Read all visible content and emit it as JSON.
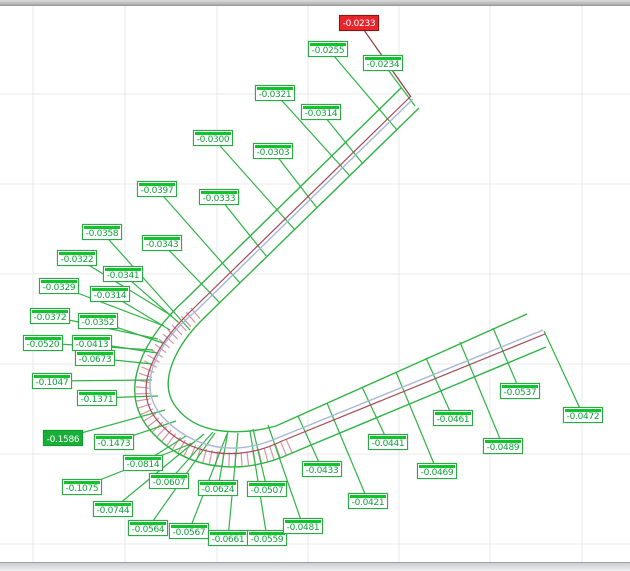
{
  "window": {
    "top_edge_color": "#ababab",
    "scrollbar": {
      "orientation": "horizontal",
      "track_color": "#d9dce0"
    }
  },
  "grid": {
    "color": "#e8e8e8",
    "vlines": [
      33,
      125,
      217,
      308,
      399,
      490,
      582
    ],
    "hlines": [
      94,
      184,
      274,
      364,
      454,
      544
    ]
  },
  "profile": {
    "colors": {
      "tolerance_green": "#2fb345",
      "nominal_blue": "#a8b6d8",
      "measured_red": "#a34a56",
      "whisker_pink": "#d893a1",
      "leader_green": "#2fb345",
      "leader_red": "#8c3a44"
    },
    "paths": {
      "whisker_band": "M 196,313 C 152,349 126,389 155,424 C 190,464 242,468 290,446",
      "outer_green": "M 401,88 L 186,299 C 144,337 116,390 150,430 C 186,472 243,476 292,453 L 546,347",
      "inner_green": "M 419,108 L 205,317 C 178,343 156,381 176,407 C 195,433 235,437 276,426 L 527,314",
      "measured_red": "M 411,96 L 194,308 C 157,343 130,387 157,420 C 188,458 240,462 282,441 L 545,334",
      "nominal_blue": "M 413,99 L 196,311 C 158,342 136,382 160,414 C 192,450 235,457 280,437 L 543,330"
    }
  },
  "measurements": {
    "description": "profile deviation flags",
    "styles": {
      "normal": "green-outline",
      "max": "green-filled",
      "red": "red-filled"
    },
    "labels": [
      {
        "v": "-0.0233",
        "x": 339,
        "y": 15,
        "ax": 411,
        "ay": 97,
        "style": "red"
      },
      {
        "v": "-0.0255",
        "x": 308,
        "y": 41,
        "ax": 397,
        "ay": 130,
        "style": "normal"
      },
      {
        "v": "-0.0234",
        "x": 363,
        "y": 55,
        "ax": 415,
        "ay": 106,
        "style": "normal"
      },
      {
        "v": "-0.0321",
        "x": 255,
        "y": 85,
        "ax": 350,
        "ay": 176,
        "style": "normal"
      },
      {
        "v": "-0.0314",
        "x": 301,
        "y": 104,
        "ax": 363,
        "ay": 164,
        "style": "normal"
      },
      {
        "v": "-0.0300",
        "x": 193,
        "y": 130,
        "ax": 295,
        "ay": 230,
        "style": "normal"
      },
      {
        "v": "-0.0303",
        "x": 253,
        "y": 143,
        "ax": 317,
        "ay": 208,
        "style": "normal"
      },
      {
        "v": "-0.0397",
        "x": 137,
        "y": 181,
        "ax": 240,
        "ay": 283,
        "style": "normal"
      },
      {
        "v": "-0.0333",
        "x": 199,
        "y": 189,
        "ax": 267,
        "ay": 257,
        "style": "normal"
      },
      {
        "v": "-0.0358",
        "x": 82,
        "y": 224,
        "ax": 190,
        "ay": 330,
        "style": "normal"
      },
      {
        "v": "-0.0343",
        "x": 142,
        "y": 235,
        "ax": 220,
        "ay": 303,
        "style": "normal"
      },
      {
        "v": "-0.0322",
        "x": 57,
        "y": 250,
        "ax": 172,
        "ay": 316,
        "style": "normal"
      },
      {
        "v": "-0.0341",
        "x": 103,
        "y": 266,
        "ax": 178,
        "ay": 322,
        "style": "normal"
      },
      {
        "v": "-0.0329",
        "x": 39,
        "y": 278,
        "ax": 164,
        "ay": 326,
        "style": "normal"
      },
      {
        "v": "-0.0314",
        "x": 90,
        "y": 286,
        "ax": 170,
        "ay": 330,
        "style": "normal"
      },
      {
        "v": "-0.0372",
        "x": 30,
        "y": 308,
        "ax": 158,
        "ay": 339,
        "style": "normal"
      },
      {
        "v": "-0.0352",
        "x": 78,
        "y": 313,
        "ax": 163,
        "ay": 343,
        "style": "normal"
      },
      {
        "v": "-0.0520",
        "x": 23,
        "y": 335,
        "ax": 153,
        "ay": 350,
        "style": "normal"
      },
      {
        "v": "-0.0413",
        "x": 72,
        "y": 335,
        "ax": 157,
        "ay": 353,
        "style": "normal"
      },
      {
        "v": "-0.0673",
        "x": 75,
        "y": 350,
        "ax": 152,
        "ay": 364,
        "style": "normal"
      },
      {
        "v": "-0.1047",
        "x": 32,
        "y": 373,
        "ax": 152,
        "ay": 380,
        "style": "normal"
      },
      {
        "v": "-0.1371",
        "x": 77,
        "y": 390,
        "ax": 158,
        "ay": 396,
        "style": "normal"
      },
      {
        "v": "-0.1586",
        "x": 43,
        "y": 430,
        "ax": 165,
        "ay": 410,
        "style": "max"
      },
      {
        "v": "-0.1473",
        "x": 94,
        "y": 434,
        "ax": 176,
        "ay": 421,
        "style": "normal"
      },
      {
        "v": "-0.0814",
        "x": 123,
        "y": 455,
        "ax": 186,
        "ay": 436,
        "style": "normal"
      },
      {
        "v": "-0.1075",
        "x": 62,
        "y": 479,
        "ax": 193,
        "ay": 443,
        "style": "normal"
      },
      {
        "v": "-0.0607",
        "x": 149,
        "y": 473,
        "ax": 213,
        "ay": 432,
        "style": "normal"
      },
      {
        "v": "-0.0744",
        "x": 93,
        "y": 501,
        "ax": 204,
        "ay": 434,
        "style": "normal"
      },
      {
        "v": "-0.0564",
        "x": 128,
        "y": 520,
        "ax": 215,
        "ay": 433,
        "style": "normal"
      },
      {
        "v": "-0.0567",
        "x": 169,
        "y": 523,
        "ax": 227,
        "ay": 434,
        "style": "normal"
      },
      {
        "v": "-0.0624",
        "x": 198,
        "y": 480,
        "ax": 228,
        "ay": 431,
        "style": "normal"
      },
      {
        "v": "-0.0661",
        "x": 208,
        "y": 530,
        "ax": 238,
        "ay": 433,
        "style": "normal"
      },
      {
        "v": "-0.0559",
        "x": 247,
        "y": 530,
        "ax": 250,
        "ay": 431,
        "style": "normal"
      },
      {
        "v": "-0.0507",
        "x": 247,
        "y": 481,
        "ax": 253,
        "ay": 429,
        "style": "normal"
      },
      {
        "v": "-0.0481",
        "x": 283,
        "y": 518,
        "ax": 268,
        "ay": 425,
        "style": "normal"
      },
      {
        "v": "-0.0433",
        "x": 302,
        "y": 461,
        "ax": 298,
        "ay": 416,
        "style": "normal"
      },
      {
        "v": "-0.0421",
        "x": 348,
        "y": 493,
        "ax": 327,
        "ay": 403,
        "style": "normal"
      },
      {
        "v": "-0.0441",
        "x": 368,
        "y": 434,
        "ax": 362,
        "ay": 387,
        "style": "normal"
      },
      {
        "v": "-0.0469",
        "x": 417,
        "y": 463,
        "ax": 396,
        "ay": 372,
        "style": "normal"
      },
      {
        "v": "-0.0461",
        "x": 433,
        "y": 410,
        "ax": 426,
        "ay": 358,
        "style": "normal"
      },
      {
        "v": "-0.0489",
        "x": 483,
        "y": 438,
        "ax": 460,
        "ay": 342,
        "style": "normal"
      },
      {
        "v": "-0.0537",
        "x": 500,
        "y": 383,
        "ax": 493,
        "ay": 328,
        "style": "normal"
      },
      {
        "v": "-0.0472",
        "x": 563,
        "y": 407,
        "ax": 544,
        "ay": 331,
        "style": "normal"
      }
    ]
  }
}
